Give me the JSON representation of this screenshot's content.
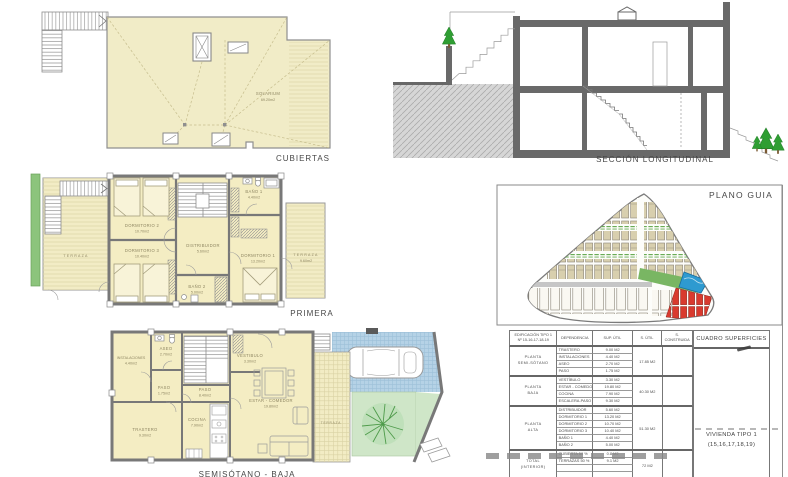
{
  "colors": {
    "plan_fill": "#f2ecc5",
    "wall_gray": "#787878",
    "section_gray": "#696969",
    "terrace_green": "#8cc47c",
    "parking_blue": "#b5d2e6",
    "garden_green": "#cfe6c8",
    "pool_blue": "#2e9ad0",
    "highlight_red": "#d93a2e",
    "house_tan": "#d8cfae"
  },
  "cubiertas": {
    "title": "CUBIERTAS",
    "solarium_name": "SOLARIUM",
    "solarium_area": "69.20m2"
  },
  "seccion": {
    "title": "SECCIÓN  LONGITUDINAL"
  },
  "primera": {
    "title": "PRIMERA",
    "terraza_left": "TERRAZA",
    "dorm2": {
      "name": "DORMITORIO 2",
      "area": "10.70m2"
    },
    "dorm3": {
      "name": "DORMITORIO 3",
      "area": "10.40m2"
    },
    "distribuidor": {
      "name": "DISTRIBUIDOR",
      "area": "5.60m2"
    },
    "bano1": {
      "name": "BAÑO 1",
      "area": "4.40m2"
    },
    "bano2": {
      "name": "BAÑO 2",
      "area": "5.00m2"
    },
    "dorm1": {
      "name": "DORMITORIO 1",
      "area": "13.20m2"
    },
    "terraza_right": {
      "name": "TERRAZA",
      "area": "9.60m2"
    }
  },
  "semisotano": {
    "title": "SEMISÓTANO - BAJA",
    "instalaciones": {
      "name": "INSTALACIONES",
      "area": "4.40m2"
    },
    "aseo": {
      "name": "ASEO",
      "area": "2.70m2"
    },
    "paso1": {
      "name": "PASO",
      "area": "1.75m2"
    },
    "paso2": {
      "name": "PASO",
      "area": "8.40m2"
    },
    "vestibulo": {
      "name": "VESTIBULO",
      "area": "3.30m2"
    },
    "estar": {
      "name": "ESTAR - COMEDOR",
      "area": "19.80m2"
    },
    "cocina": {
      "name": "COCINA",
      "area": "7.90m2"
    },
    "trastero": {
      "name": "TRASTERO",
      "area": "9.30m2"
    },
    "terraza": {
      "name": "TERRAZA"
    }
  },
  "plano_guia": {
    "title": "PLANO GUIA"
  },
  "tabla": {
    "titulo": "CUADRO SUPERFICIES",
    "header": {
      "edificacion": "EDIFICACIÓN TIPO 1",
      "edificacion2": "Nº 15-16-17-18-19",
      "dependencia": "DEPENDENCIA",
      "sup_util": "SUP. ÚTIL",
      "s_util": "S. ÚTIL",
      "s_construida": "S. CONSTRUIDA"
    },
    "grupos": [
      {
        "planta": "PLANTA",
        "planta2": "SEMI-SÓTANO",
        "total": "17.85 M2",
        "rows": [
          {
            "dep": "TRASTERO",
            "sup": "9.00 M2"
          },
          {
            "dep": "INSTALACIONES",
            "sup": "4.40 M2"
          },
          {
            "dep": "ASEO",
            "sup": "2.70 M2"
          },
          {
            "dep": "PASO",
            "sup": "1.75 M2"
          }
        ]
      },
      {
        "planta": "PLANTA",
        "planta2": "BAJA",
        "total": "40.30 M2",
        "rows": [
          {
            "dep": "VESTÍBULO",
            "sup": "3.30 M2"
          },
          {
            "dep": "ESTAR - COMEDOR",
            "sup": "19.80 M2"
          },
          {
            "dep": "COCINA",
            "sup": "7.90 M2"
          },
          {
            "dep": "ESCALERA-PASO",
            "sup": "9.30 M2"
          }
        ]
      },
      {
        "planta": "PLANTA",
        "planta2": "ALTA",
        "total": "51.30 M2",
        "rows": [
          {
            "dep": "DISTRIBUIDOR",
            "sup": "5.60 M2"
          },
          {
            "dep": "DORMITORIO 1",
            "sup": "13.20 M2"
          },
          {
            "dep": "DORMITORIO 2",
            "sup": "10.70 M2"
          },
          {
            "dep": "DORMITORIO 3",
            "sup": "10.40 M2"
          },
          {
            "dep": "BAÑO 1",
            "sup": "4.40 M2"
          },
          {
            "dep": "BAÑO 2",
            "sup": "5.00 M2"
          }
        ]
      }
    ],
    "footer": {
      "planta": "TOTAL",
      "planta2": "(INTERIOR)",
      "total": "72 M2",
      "rows": [
        {
          "dep": "CUBIERTA 50 %",
          "sup": "0.8 M2"
        },
        {
          "dep": "TERRAZAS 50 %",
          "sup": "9.1 M2"
        }
      ]
    },
    "vivienda": "VIVIENDA TIPO 1",
    "vivienda2": "(15,16,17,18,19)"
  }
}
